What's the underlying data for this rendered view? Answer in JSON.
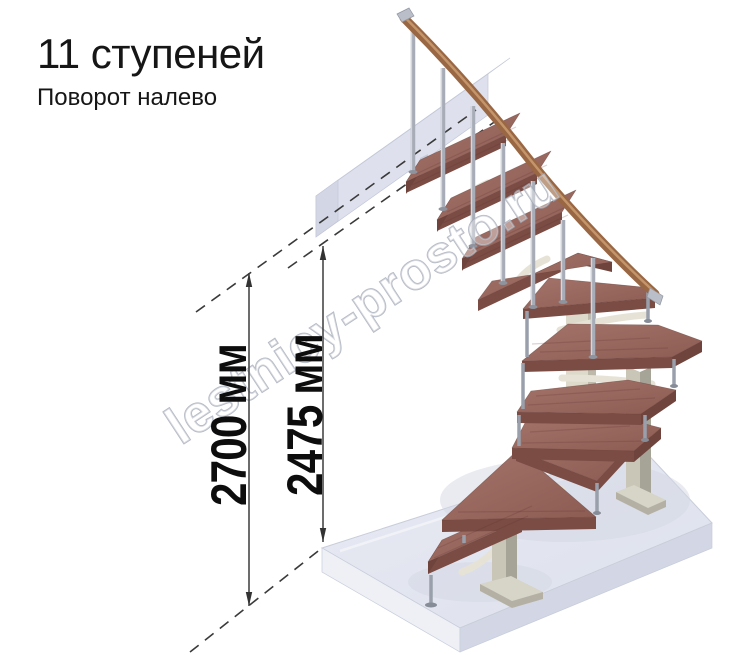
{
  "header": {
    "title": "11 ступеней",
    "subtitle": "Поворот налево"
  },
  "dimensions": {
    "overall": {
      "label": "2700 мм",
      "value": 2700,
      "unit": "мм"
    },
    "secondary": {
      "label": "2475 мм",
      "value": 2475,
      "unit": "мм"
    }
  },
  "watermark": {
    "text": "lestnicy-prosto.ru"
  },
  "illustration": {
    "description": "3D render of a modular staircase with 11 wooden treads turning left, metal balusters and handrail, upper landing beam and floor slab",
    "colors": {
      "tread_top": "#9c6b62",
      "tread_front": "#7a4c44",
      "handrail": "#996743",
      "metal": "#a7acb6",
      "column_light": "#c9c6b8",
      "column_shade": "#a6a497",
      "bracket_cream": "#e6e3d6",
      "landing_top": "#e9ebf4",
      "landing_front": "#dee1ed",
      "floor_top": "#e3e6f0",
      "floor_side": "#d3d7e5",
      "dimension_line": "#3c3c3c",
      "watermark_outline": "#a2a8b6"
    }
  }
}
